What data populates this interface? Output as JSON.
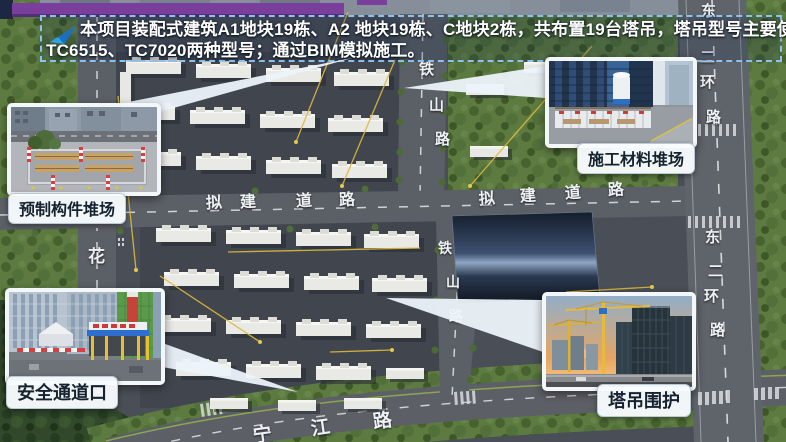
{
  "banner": {
    "icon": "send-arrow-icon",
    "line1": "本项目装配式建筑A1地块19栋、A2 地块19栋、C地块2栋，共布置19台塔吊，塔吊型号主要使用",
    "line2": "TC6515、TC7020两种型号；通过BIM模拟施工。"
  },
  "callouts": [
    {
      "id": "precast-yard",
      "label": "预制构件堆场"
    },
    {
      "id": "material-yard",
      "label": "施工材料堆场"
    },
    {
      "id": "safety-entrance",
      "label": "安全通道口"
    },
    {
      "id": "crane-enclosure",
      "label": "塔吊围护"
    }
  ],
  "map": {
    "road_labels": [
      {
        "road": "tieshan-lu-upper",
        "char": "铁",
        "x": 419,
        "y": 62,
        "s": 15
      },
      {
        "road": "tieshan-lu-upper",
        "char": "山",
        "x": 429,
        "y": 98,
        "s": 15
      },
      {
        "road": "tieshan-lu-upper",
        "char": "路",
        "x": 435,
        "y": 132,
        "s": 15
      },
      {
        "road": "tieshan-lu-lower",
        "char": "铁",
        "x": 438,
        "y": 241,
        "s": 14
      },
      {
        "road": "tieshan-lu-lower",
        "char": "山",
        "x": 446,
        "y": 275,
        "s": 14
      },
      {
        "road": "tieshan-lu-lower",
        "char": "路",
        "x": 449,
        "y": 309,
        "s": 14
      },
      {
        "road": "nijian-daolu-west",
        "char": "拟",
        "x": 206,
        "y": 196,
        "s": 16,
        "r": -3
      },
      {
        "road": "nijian-daolu-west",
        "char": "建",
        "x": 240,
        "y": 195,
        "s": 16,
        "r": -3
      },
      {
        "road": "nijian-daolu-west",
        "char": "道",
        "x": 296,
        "y": 194,
        "s": 16,
        "r": -3
      },
      {
        "road": "nijian-daolu-west",
        "char": "路",
        "x": 339,
        "y": 193,
        "s": 16,
        "r": -3
      },
      {
        "road": "nijian-daolu-east",
        "char": "拟",
        "x": 479,
        "y": 192,
        "s": 16,
        "r": -4
      },
      {
        "road": "nijian-daolu-east",
        "char": "建",
        "x": 520,
        "y": 189,
        "s": 16,
        "r": -4
      },
      {
        "road": "nijian-daolu-east",
        "char": "道",
        "x": 565,
        "y": 186,
        "s": 16,
        "r": -4
      },
      {
        "road": "nijian-daolu-east",
        "char": "路",
        "x": 608,
        "y": 183,
        "s": 16,
        "r": -4
      },
      {
        "road": "dongerhuan-lu-upper",
        "char": "东",
        "x": 701,
        "y": 4,
        "s": 15
      },
      {
        "road": "dongerhuan-lu-upper",
        "char": "二",
        "x": 700,
        "y": 50,
        "s": 15
      },
      {
        "road": "dongerhuan-lu-upper",
        "char": "环",
        "x": 700,
        "y": 75,
        "s": 15
      },
      {
        "road": "dongerhuan-lu-upper",
        "char": "路",
        "x": 706,
        "y": 110,
        "s": 15
      },
      {
        "road": "dongerhuan-lu-lower",
        "char": "东",
        "x": 705,
        "y": 230,
        "s": 15
      },
      {
        "road": "dongerhuan-lu-lower",
        "char": "二",
        "x": 708,
        "y": 264,
        "s": 15
      },
      {
        "road": "dongerhuan-lu-lower",
        "char": "环",
        "x": 704,
        "y": 289,
        "s": 15
      },
      {
        "road": "dongerhuan-lu-lower",
        "char": "路",
        "x": 710,
        "y": 323,
        "s": 15
      },
      {
        "road": "hua-lu",
        "char": "花",
        "x": 88,
        "y": 248,
        "s": 17
      },
      {
        "road": "ningjiang-lu",
        "char": "宁",
        "x": 253,
        "y": 426,
        "s": 19,
        "r": -8
      },
      {
        "road": "ningjiang-lu",
        "char": "江",
        "x": 311,
        "y": 419,
        "s": 19,
        "r": -8
      },
      {
        "road": "ningjiang-lu",
        "char": "路",
        "x": 373,
        "y": 412,
        "s": 19,
        "r": -8
      }
    ]
  },
  "colors": {
    "purple_bar": "#7a3f9d",
    "banner_border": "#8ec1ee",
    "banner_text": "#ffffff",
    "pill_bg": "#f9fcfe",
    "pill_text": "#15222f",
    "road_label": "#eef1f4",
    "crane_line_yellow": "#ddba3e",
    "callout_fill": "#ecf3fa"
  }
}
